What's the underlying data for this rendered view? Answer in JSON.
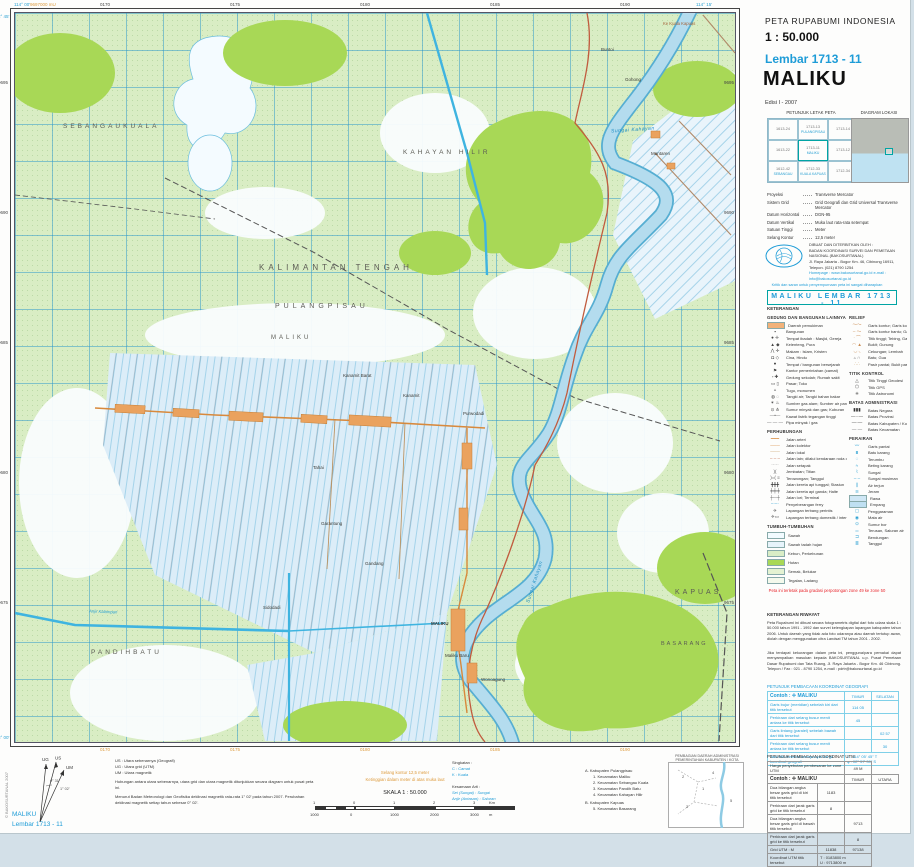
{
  "header": {
    "agency": "PETA RUPABUMI INDONESIA",
    "scale": "1 : 50.000",
    "sheet": "Lembar 1713 - 11",
    "title": "MALIKU",
    "edition": "Edisi I - 2007"
  },
  "index_map": {
    "title": "PETUNJUK LETAK PETA",
    "diagram_title": "DIAGRAM LOKASI",
    "cells": [
      {
        "n": "1613-24",
        "s": ""
      },
      {
        "n": "1713-13",
        "s": "PULANGPISAU"
      },
      {
        "n": "1713-14",
        "s": ""
      },
      {
        "n": "1613-22",
        "s": ""
      },
      {
        "n": "1713-11",
        "s": "MALIKU",
        "sel": true
      },
      {
        "n": "1713-12",
        "s": ""
      },
      {
        "n": "1612-42",
        "s": "SEBANGAU"
      },
      {
        "n": "1712-33",
        "s": "KUALA KAPUAS"
      },
      {
        "n": "1712-34",
        "s": ""
      }
    ]
  },
  "projection": {
    "rows": [
      {
        "label": "Proyeksi",
        "value": "Transverse Mercator"
      },
      {
        "label": "Sistem Grid",
        "value": "Grid Geografi dan Grid Universal Transverse Mercator"
      },
      {
        "label": "Datum Horizontal",
        "value": "DGN-95"
      },
      {
        "label": "Datum Vertikal",
        "value": "Muka laut rata-rata setempat"
      },
      {
        "label": "Satuan Tinggi",
        "value": "Meter"
      },
      {
        "label": "Selang Kontur",
        "value": "12,5 meter"
      }
    ]
  },
  "publisher": {
    "intro": "DIBUAT DAN DITERBITKAN OLEH :",
    "name": "BADAN KOORDINASI SURVEI DAN PEMETAAN NASIONAL (BAKOSURTANAL)",
    "address": "Jl. Raya Jakarta - Bogor Km. 46, Cibinong 16911, Telepon. (021) 8790 1254",
    "web": "Homepage : www.bakosurtanal.go.id   e-mail : info@bakosurtanal.go.id"
  },
  "feedback_note": "Kritik dan saran untuk penyempurnaan peta ini sangat diharapkan",
  "banner": "MALIKU   LEMBAR   1713 - 11",
  "legend": {
    "title": "KETERANGAN",
    "zone_note": "Peta ini terletak pada gradasi perpotongan zone 49 ke zone 50",
    "sections_left": [
      {
        "title": "GEDUNG DAN BANGUNAN LAINNYA",
        "items": [
          {
            "t": "Daerah pemukiman",
            "bg": "#f2b27a"
          },
          {
            "t": "Bangunan",
            "g": "▪",
            "c": "#444"
          },
          {
            "t": "Tempat ibadah : Masjid, Gereja",
            "g": "● ✛",
            "c": "#444"
          },
          {
            "t": "Kelenteng, Pura",
            "g": "▲ ◆",
            "c": "#444"
          },
          {
            "t": "Makam : Islam, Kristen",
            "g": "⋀ ✛",
            "c": "#444"
          },
          {
            "t": "Cina, Hindu",
            "g": "Ω ◇",
            "c": "#444"
          },
          {
            "t": "Tempat / bangunan bersejarah",
            "g": "●",
            "c": "#444"
          },
          {
            "t": "Kantor pemerintahan (camat)",
            "g": "⚑",
            "c": "#444"
          },
          {
            "t": "Gedung sekolah; Rumah sakit",
            "g": "▫ ✚",
            "c": "#444"
          },
          {
            "t": "Pasar; Toko",
            "g": "▭ ▯",
            "c": "#444"
          },
          {
            "t": "Tugu, monumen",
            "g": "▵",
            "c": "#444"
          },
          {
            "t": "Tangki air; Tangki bahan bakar",
            "g": "◍ ◌",
            "c": "#444"
          },
          {
            "t": "Sumber gas alam; Sumber air panas",
            "g": "✶ ♨",
            "c": "#444"
          },
          {
            "t": "Sumur minyak dan gas; Kuburan",
            "g": "⊙ ⋔",
            "c": "#444"
          },
          {
            "t": "Kawat listrik tegangan tinggi",
            "g": "—•—",
            "c": "#666"
          },
          {
            "t": "Pipa minyak / gas",
            "g": "— — —",
            "c": "#666"
          }
        ]
      },
      {
        "title": "PERHUBUNGAN",
        "items": [
          {
            "t": "Jalan arteri",
            "g": "━━━",
            "c": "#d8893c"
          },
          {
            "t": "Jalan kolektor",
            "g": "───",
            "c": "#d8893c"
          },
          {
            "t": "Jalan lokal",
            "g": "───",
            "c": "#c9a06a"
          },
          {
            "t": "Jalan lain; dilalui kendaraan roda dua",
            "g": "– – –",
            "c": "#c06a4a"
          },
          {
            "t": "Jalan setapak",
            "g": "·····",
            "c": "#777"
          },
          {
            "t": "Jembatan; Titian",
            "g": ")(",
            "c": "#555"
          },
          {
            "t": "Terowongan; Tanggul",
            "g": ")=( ≡",
            "c": "#555"
          },
          {
            "t": "Jalan kereta api tunggal; Stasiun",
            "g": "╋╋╋",
            "c": "#333"
          },
          {
            "t": "Jalan kereta api ganda; Halte",
            "g": "╪╪╪",
            "c": "#333"
          },
          {
            "t": "Jalan lori; Terminal",
            "g": "┼─┼",
            "c": "#555"
          },
          {
            "t": "Penyeberangan ferry",
            "g": "–·–·",
            "c": "#2aa0d2"
          },
          {
            "t": "Lapangan terbang perintis",
            "g": "✈",
            "c": "#555"
          },
          {
            "t": "Lapangan terbang domestik / internasional",
            "g": "✈▭",
            "c": "#555"
          }
        ]
      },
      {
        "title": "TUMBUH-TUMBUHAN",
        "veg": true,
        "items": [
          {
            "t": "Sawah",
            "bg": "#f2fbff"
          },
          {
            "t": "Sawah tadah hujan",
            "bg": "#e7f4fb"
          },
          {
            "t": "Kebun, Perkebunan",
            "bg": "#d9edc6"
          },
          {
            "t": "Hutan",
            "bg": "#a8d856"
          },
          {
            "t": "Semak, Belukar",
            "bg": "#e4f2d2"
          },
          {
            "t": "Tegalan, Ladang",
            "bg": "#f4f9ec"
          }
        ]
      }
    ],
    "sections_right": [
      {
        "title": "RELIEF",
        "items": [
          {
            "t": "Garis kontur; Garis kontur indeks",
            "g": "〜〜",
            "c": "#c98a50"
          },
          {
            "t": "Garis kontur bantu; Garis depresi",
            "g": "– 〜",
            "c": "#c98a50"
          },
          {
            "t": "Titik tinggi; Tebing, Gawir",
            "g": "· ⌒",
            "c": "#c98a50"
          },
          {
            "t": "Bukit; Gunung",
            "g": "◠ ▲",
            "c": "#c98a50"
          },
          {
            "t": "Cekungan; Lembah",
            "g": "◡ ◟",
            "c": "#c98a50"
          },
          {
            "t": "Batu; Gua",
            "g": "▵ ∩",
            "c": "#888"
          },
          {
            "t": "Pasir pantai; Bukit pasir",
            "g": "∴∴",
            "c": "#c9a06a"
          }
        ]
      },
      {
        "title": "TITIK KONTROL",
        "items": [
          {
            "t": "Titik Tinggi Geodesi",
            "g": "△",
            "c": "#333"
          },
          {
            "t": "Titik GPS",
            "g": "⬠",
            "c": "#333"
          },
          {
            "t": "Titik Astronomi",
            "g": "✳",
            "c": "#333"
          }
        ]
      },
      {
        "title": "BATAS ADMINISTRASI",
        "items": [
          {
            "t": "Batas Negara",
            "g": "▮▮▮",
            "c": "#333"
          },
          {
            "t": "Batas Provinsi",
            "g": "—··—",
            "c": "#333"
          },
          {
            "t": "Batas Kabupaten / Kota",
            "g": "—·—",
            "c": "#333"
          },
          {
            "t": "Batas Kecamatan",
            "g": "— —",
            "c": "#666"
          }
        ]
      },
      {
        "title": "PERAIRAN",
        "items": [
          {
            "t": "Garis pantai",
            "g": "〰",
            "c": "#2aa0d2"
          },
          {
            "t": "Batu karang",
            "g": "⩩",
            "c": "#2aa0d2"
          },
          {
            "t": "Terumbu",
            "g": "◌",
            "c": "#2aa0d2"
          },
          {
            "t": "Beting karang",
            "g": "≈",
            "c": "#2aa0d2"
          },
          {
            "t": "Sungai",
            "g": "⌇",
            "c": "#2aa0d2"
          },
          {
            "t": "Sungai musiman",
            "g": "– –",
            "c": "#2aa0d2"
          },
          {
            "t": "Air terjun",
            "g": "❙",
            "c": "#2aa0d2"
          },
          {
            "t": "Jeram",
            "g": "≋",
            "c": "#2aa0d2"
          },
          {
            "t": "Rawa",
            "bg": "#cfe7f5"
          },
          {
            "t": "Empang",
            "bg": "#bfe0f2"
          },
          {
            "t": "Penggaraman",
            "g": "▢",
            "c": "#2aa0d2"
          },
          {
            "t": "Mata air",
            "g": "◉",
            "c": "#2aa0d2"
          },
          {
            "t": "Sumur bor",
            "g": "⊙",
            "c": "#2aa0d2"
          },
          {
            "t": "Terusan, Saluran air",
            "g": "═",
            "c": "#2aa0d2"
          },
          {
            "t": "Bendungan",
            "g": "⊐",
            "c": "#2aa0d2"
          },
          {
            "t": "Tanggul",
            "g": "≣",
            "c": "#2aa0d2"
          }
        ]
      }
    ]
  },
  "history": {
    "title": "KETERANGAN RIWAYAT",
    "p1": "Peta Rupabumi ini dibuat secara fotogrametris digital dari foto udara skala 1 : 50.000 tahun 1991 - 1992 dan survei kelengkapan lapangan kabupaten tahun 2006. Untuk daerah yang tidak ada foto udaranya atau daerah tertutup awan, diolah dengan menggunakan citra Landsat TM tahun 2001 - 2002.",
    "p2": "Jika terdapat kekurangan dalam peta ini, pengguna/para pemakai dapat menyampaikan masukan kepada BAKOSURTANAL u.p. Pusat Pemetaan Dasar Rupabumi dan Tata Ruang, Jl. Raya Jakarta - Bogor Km. 46 Cibinong. Telepon / Fax : 021 - 8790 1254, e-mail : pdrtr@bakosurtanal.go.id"
  },
  "geo_table": {
    "title": "PETUNJUK PEMBACAAN KOORDINAT GEOGRAFI",
    "example": "Contoh : ✛ MALIKU",
    "col1": "TIMUR",
    "col2": "SELATAN",
    "rows": [
      {
        "d": "Garis bujur (meridian) sebelah kiri dari titik tersebut",
        "v1": "114 05",
        "v2": ""
      },
      {
        "d": "Perkiraan dari selang busur menit antara ke titik tersebut",
        "v1": "45",
        "v2": ""
      },
      {
        "d": "Garis lintang (paralel) sebelah bawah dari titik tersebut",
        "v1": "",
        "v2": "02 57"
      },
      {
        "d": "Perkiraan dari selang busur menit antara ke titik tersebut",
        "v1": "",
        "v2": "30"
      }
    ],
    "result_label": "Jadi titik tersebut mempunyai harga koordinat geografi",
    "result1": "λ : 114° 05' 45\" T",
    "result2": "φ : 02° 57' 30\" S"
  },
  "utm_table": {
    "title": "PETUNJUK PEMBACAAN KOORDINAT UTM",
    "zone_label": "Harga penyebutan pembesaran ke zone UTM",
    "zone_value": "49 M",
    "example": "Contoh : ✛ MALIKU",
    "col1": "TIMUR",
    "col2": "UTARA",
    "rows": [
      {
        "d": "Dua bilangan angka besar garis grid di kiri titik tersebut",
        "v1": "1183",
        "v2": ""
      },
      {
        "d": "Perkiraan dari jarak garis grid ke titik tersebut",
        "v1": "8",
        "v2": ""
      },
      {
        "d": "Dua bilangan angka besar garis grid di bawah titik tersebut",
        "v1": "",
        "v2": "9713"
      },
      {
        "d": "Perkiraan dari jarak garis grid ke titik tersebut",
        "v1": "",
        "v2": "8"
      }
    ],
    "grid_label": "Grid UTM : M",
    "grid1": "11838",
    "grid2": "97138",
    "result_label": "Koordinat UTM titik tersebut",
    "result1": "T : 0183800 m",
    "result2": "U : 9713800 m"
  },
  "bottom": {
    "declination": {
      "us": "US : Utara sebenarnya (Geografi)",
      "ug": "UG : Utara grid (UTM)",
      "um": "UM : Utara magnetik",
      "p1": "Hubungan antara utara sebenarnya, utara grid dan utara magnetik ditunjukkan secara diagram untuk pusat peta ini.",
      "p2": "Menurut Badan Meteorologi dan Geofisika deklinasi magnetik rata-rata 1° 02' pada tahun 2007. Perubahan deklinasi magnetik setiap tahun sebesar 0° 02'.",
      "angle_us_ug": "0° 31'",
      "angle_us_um": "1° 02'",
      "lbl_us": "US",
      "lbl_ug": "UG",
      "lbl_um": "UM"
    },
    "abbrev": {
      "title": "Singkatan :",
      "items": [
        "C : Camat",
        "K : Kuala"
      ],
      "eq_title": "Kesamaan Arti :",
      "eq_items": [
        "Sei (Sungai) : Sungai",
        "Anjir (Antasan) : Saluran"
      ]
    },
    "contour_note1": "Selang kontur 12,5 meter",
    "contour_note2": "Ketinggian dalam meter di atas muka laut",
    "scale_label": "SKALA 1 : 50.000",
    "scalebar": {
      "top_labels": [
        "1",
        "0",
        "1",
        "2",
        "3"
      ],
      "top_unit": "Km",
      "bottom_labels": [
        "1000",
        "0",
        "1000",
        "2000",
        "3000"
      ],
      "bottom_unit": "m"
    },
    "admin_list": {
      "a_title": "A. Kabupaten Pulangpisau",
      "a_items": [
        "1. Kecamatan Maliku",
        "2. Kecamatan Sebangau Kuala",
        "3. Kecamatan Pandih Batu",
        "4. Kecamatan Kahayan Hilir"
      ],
      "b_title": "B. Kabupaten Kapuas",
      "b_items": [
        "5. Kecamatan Basarang"
      ]
    },
    "inset_title1": "PEMBAGIAN DAERAH ADMINISTRASI",
    "inset_title2": "PEMERINTAHAN KABUPATEN / KOTA",
    "corner_name": "MALIKU",
    "corner_sheet": "Lembar 1713 - 11",
    "copyright": "© BAKOSURTANAL 2007"
  },
  "map": {
    "region_labels": [
      {
        "t": "SEBANGAUKUALA",
        "x": 48,
        "y": 110,
        "s": 6.5,
        "ls": 3
      },
      {
        "t": "KAHAYAN HILIR",
        "x": 388,
        "y": 136,
        "s": 6.5,
        "ls": 3
      },
      {
        "t": "KALIMANTAN TENGAH",
        "x": 244,
        "y": 250,
        "s": 8,
        "ls": 4
      },
      {
        "t": "PULANGPISAU",
        "x": 260,
        "y": 290,
        "s": 7,
        "ls": 4
      },
      {
        "t": "MALIKU",
        "x": 256,
        "y": 322,
        "s": 6,
        "ls": 3
      },
      {
        "t": "PANDIHBATU",
        "x": 76,
        "y": 636,
        "s": 6.5,
        "ls": 3
      },
      {
        "t": "KAPUAS",
        "x": 660,
        "y": 576,
        "s": 7,
        "ls": 3
      },
      {
        "t": "BASARANG",
        "x": 646,
        "y": 628,
        "s": 5.5,
        "ls": 2
      }
    ],
    "place_labels": [
      {
        "t": "Kanamit Barat",
        "x": 328,
        "y": 360
      },
      {
        "t": "Kanamit",
        "x": 388,
        "y": 380
      },
      {
        "t": "Purwodadi",
        "x": 448,
        "y": 398
      },
      {
        "t": "Tahai",
        "x": 298,
        "y": 452
      },
      {
        "t": "Garantung",
        "x": 306,
        "y": 508
      },
      {
        "t": "Gandang",
        "x": 350,
        "y": 548
      },
      {
        "t": "Sidodadi",
        "x": 248,
        "y": 592
      },
      {
        "t": "MALIKU",
        "x": 416,
        "y": 608,
        "b": true
      },
      {
        "t": "Maliku Baru",
        "x": 430,
        "y": 640
      },
      {
        "t": "Wonoagung",
        "x": 466,
        "y": 664
      },
      {
        "t": "Buntoi",
        "x": 586,
        "y": 34
      },
      {
        "t": "Gohong",
        "x": 610,
        "y": 64
      },
      {
        "t": "Mantaren",
        "x": 636,
        "y": 138
      }
    ],
    "river_labels": [
      {
        "t": "Sungai Kahayan",
        "x": 596,
        "y": 114,
        "r": -4
      },
      {
        "t": "Sungai Kahayan",
        "x": 498,
        "y": 566,
        "r": -72
      }
    ],
    "road_labels": [
      {
        "t": "Ke Kuala Kapuas",
        "x": 648,
        "y": 8
      }
    ],
    "canal_labels": [
      {
        "t": "Anjir Kalampan",
        "x": 74,
        "y": 596,
        "r": 2
      }
    ],
    "edge": {
      "top": [
        "0170",
        "0175",
        "0180",
        "0185",
        "0190"
      ],
      "bottom": [
        "0170",
        "0175",
        "0180",
        "0185",
        "0190"
      ],
      "left": [
        "9695",
        "9690",
        "9685",
        "9680",
        "9675"
      ],
      "right": [
        "9695",
        "9690",
        "9685",
        "9680",
        "9675"
      ],
      "corner_tl": "114° 00'",
      "corner_tr": "114° 15'",
      "corner_lt": "2° 45'",
      "corner_lb": "3° 00'",
      "utm_note": "9697000 mU"
    }
  },
  "colors": {
    "accent_cyan": "#1e9cd7",
    "teal": "#00a4a4",
    "forest_green": "#a8d856",
    "base_green": "#d9edc4",
    "water_blue": "#b4dcee",
    "road_orange": "#d8893c",
    "red_note": "#e8262d"
  }
}
